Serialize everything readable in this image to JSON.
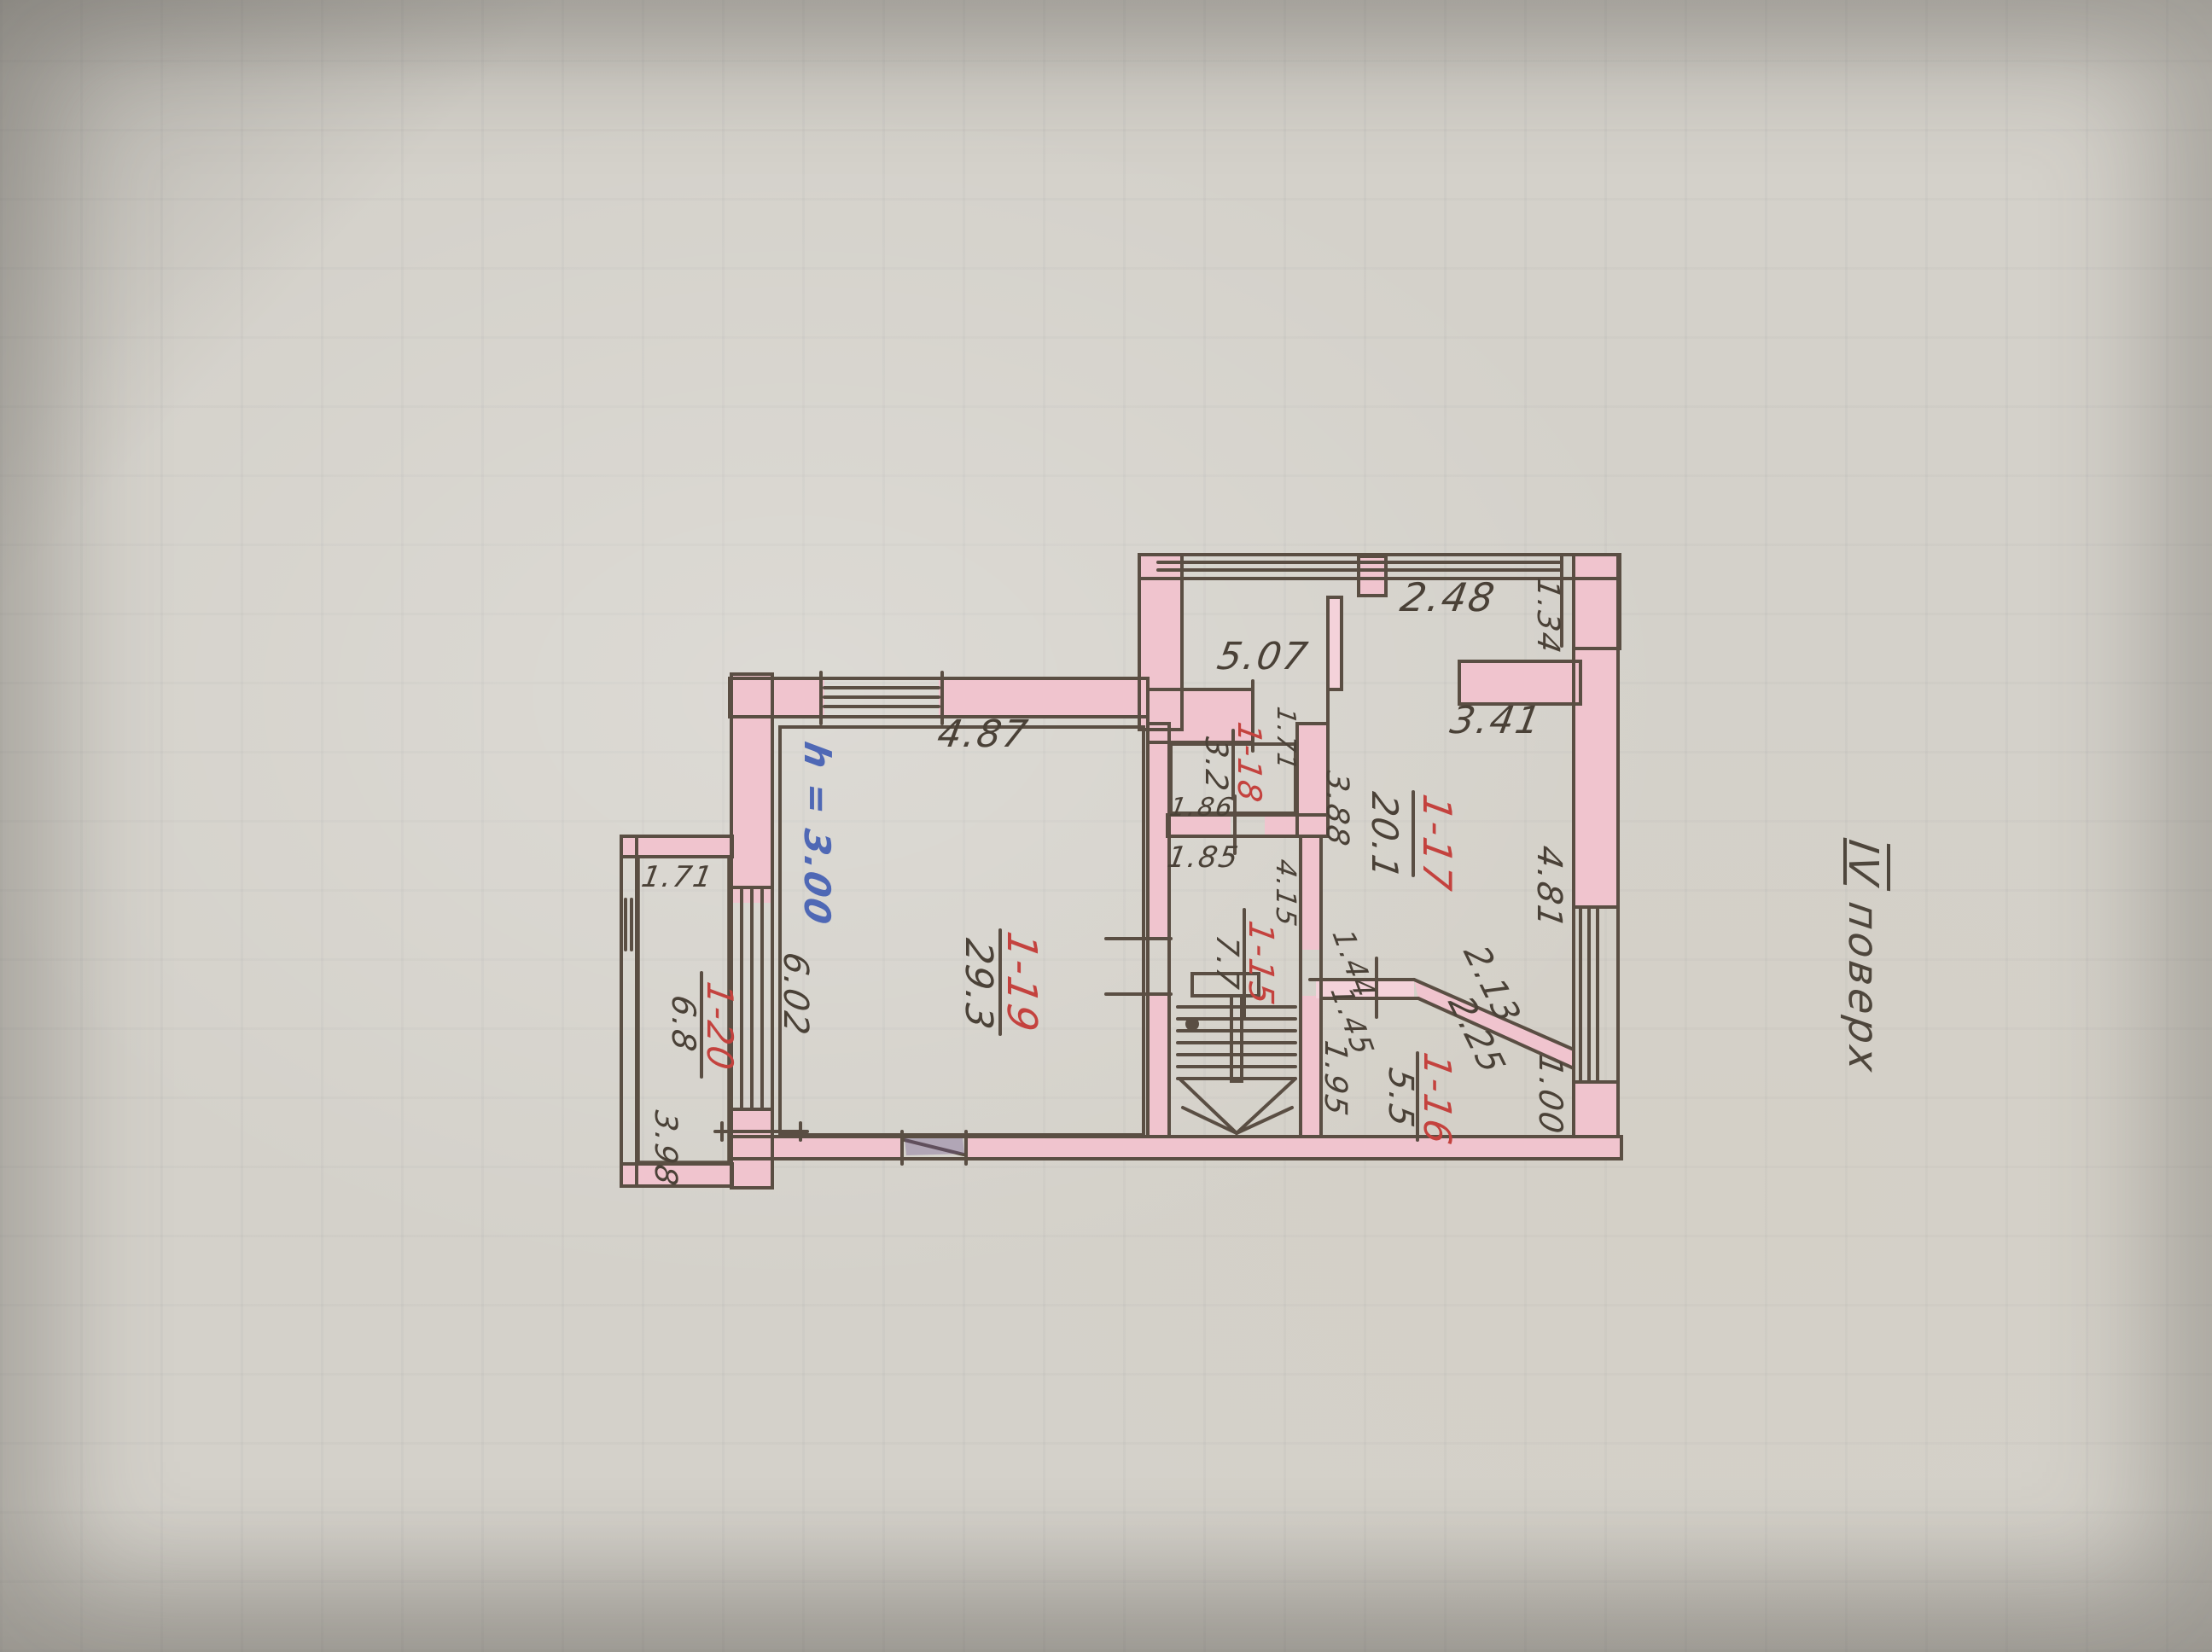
{
  "document": {
    "type_note": "hand-drawn floor plan photo",
    "floor_title": {
      "numeral": "IV",
      "word": "поверх"
    },
    "ceiling_height_note": "h = 3.00"
  },
  "colors": {
    "paper": "#d4d1ca",
    "wall_fill": "#f0c4ce",
    "ink_line": "#5a4e43",
    "pencil_text": "#4a4137",
    "room_number_red": "#c4423e",
    "note_blue": "#4f68b5"
  },
  "rooms": [
    {
      "num": "1-17",
      "area": "20.1"
    },
    {
      "num": "1-18",
      "area": "3.2"
    },
    {
      "num": "1-15",
      "area": "7.7"
    },
    {
      "num": "1-16",
      "area": "5.5"
    },
    {
      "num": "1-19",
      "area": "29.3"
    },
    {
      "num": "1-20",
      "area": "6.8"
    }
  ],
  "dims": {
    "w248": "2.48",
    "w134": "1.34",
    "w507": "5.07",
    "w341": "3.41",
    "w487": "4.87",
    "w481": "4.81",
    "w171_niche": "1.71",
    "w186": "1.86",
    "w185": "1.85",
    "w388": "3.88",
    "w171_loggia": "1.71",
    "w415": "4.15",
    "w602": "6.02",
    "w398": "3.98",
    "w144": "1.44",
    "w145": "1.45",
    "w195": "1.95",
    "w100": "1.00",
    "w213": "2.13",
    "w225": "2.25"
  }
}
